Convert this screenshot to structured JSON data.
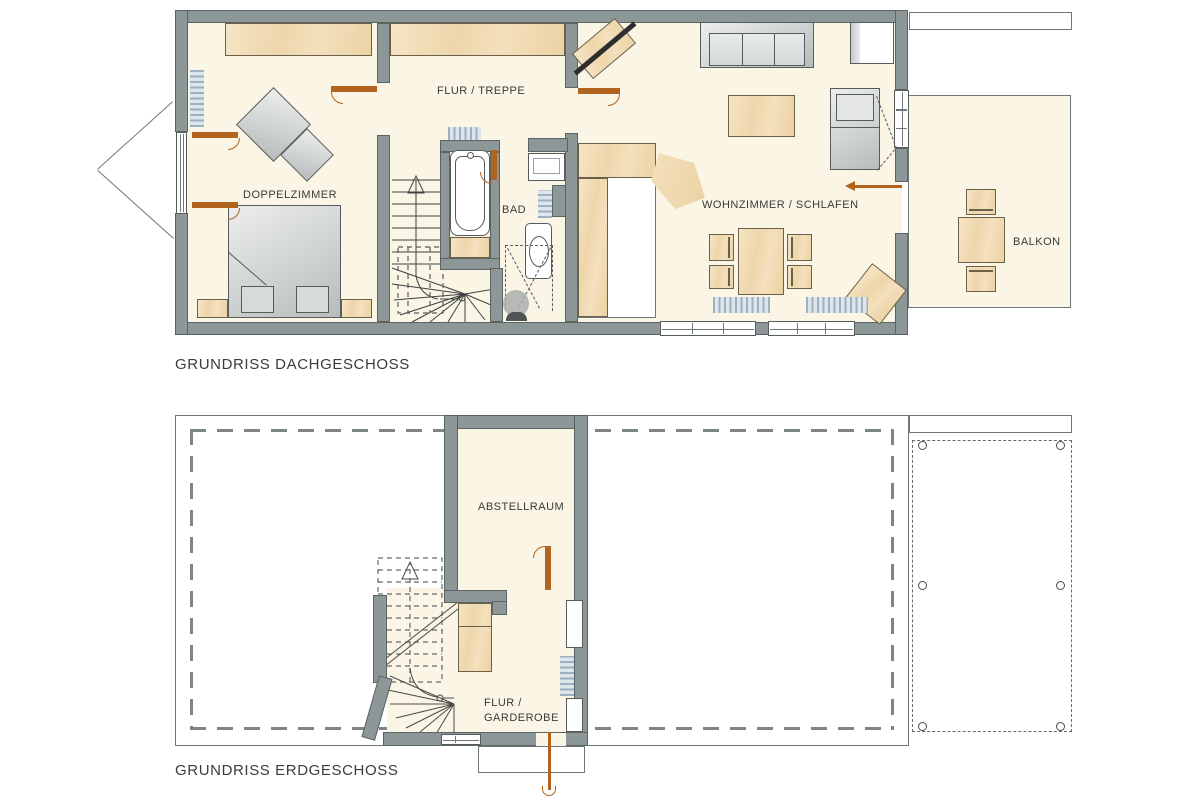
{
  "attic": {
    "title": "GRUNDRISS DACHGESCHOSS",
    "labels": {
      "hall": "FLUR / TREPPE",
      "bedroom": "DOPPELZIMMER",
      "bath": "BAD",
      "living": "WOHNZIMMER / SCHLAFEN",
      "balcony": "BALKON"
    }
  },
  "ground": {
    "title": "GRUNDRISS ERDGESCHOSS",
    "labels": {
      "storage": "ABSTELLRAUM",
      "hall_line1": "FLUR /",
      "hall_line2": "GARDEROBE"
    }
  },
  "colors": {
    "wall": "#8d9797",
    "floor": "#faf5e4",
    "wood": "#f0d9b0",
    "door": "#b2631d",
    "radiator": "#9db0bf",
    "outline": "#5a6464",
    "text": "#3a3a3a"
  }
}
